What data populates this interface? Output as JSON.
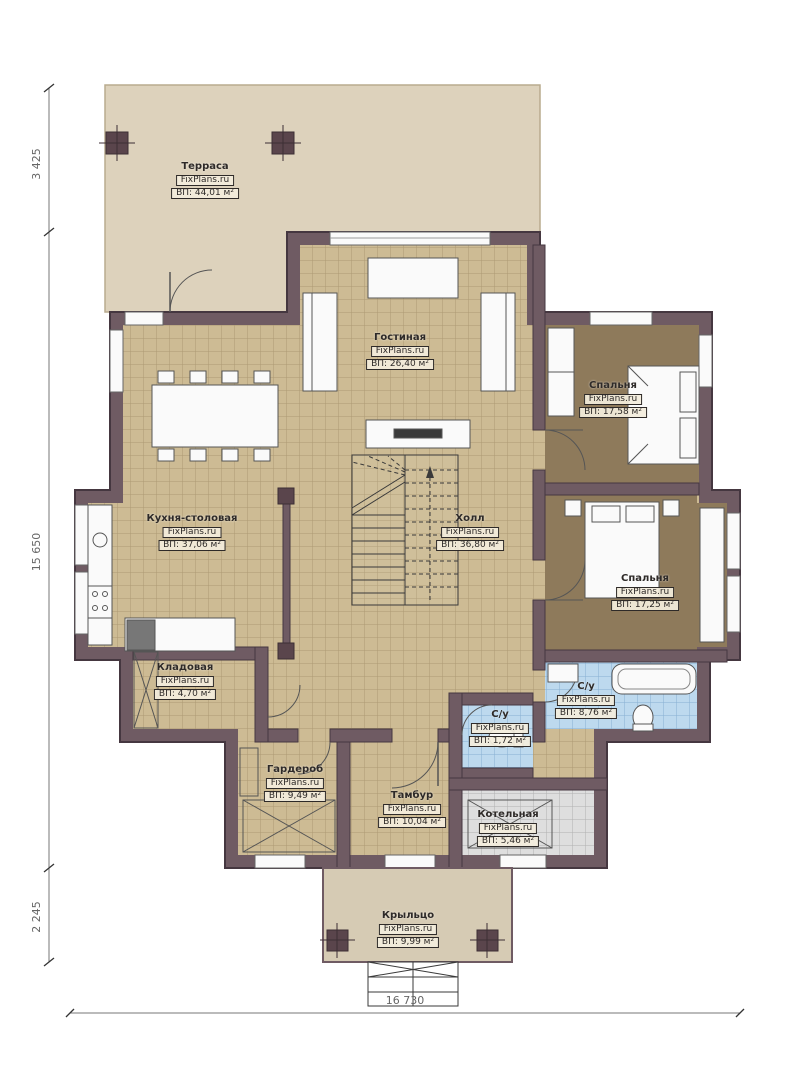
{
  "plan": {
    "brand": "FixPlans.ru",
    "rooms": [
      {
        "id": "terrace",
        "name": "Терраса",
        "area": "ВП: 44,01 м²"
      },
      {
        "id": "living",
        "name": "Гостиная",
        "area": "ВП: 26,40 м²"
      },
      {
        "id": "bedroom1",
        "name": "Спальня",
        "area": "ВП: 17,58 м²"
      },
      {
        "id": "kitchen",
        "name": "Кухня-столовая",
        "area": "ВП: 37,06 м²"
      },
      {
        "id": "hall",
        "name": "Холл",
        "area": "ВП: 36,80 м²"
      },
      {
        "id": "bedroom2",
        "name": "Спальня",
        "area": "ВП: 17,25 м²"
      },
      {
        "id": "pantry",
        "name": "Кладовая",
        "area": "ВП: 4,70 м²"
      },
      {
        "id": "bath1",
        "name": "С/у",
        "area": "ВП: 8,76 м²"
      },
      {
        "id": "bath2",
        "name": "С/у",
        "area": "ВП: 1,72 м²"
      },
      {
        "id": "wardrobe",
        "name": "Гардероб",
        "area": "ВП: 9,49 м²"
      },
      {
        "id": "vestibule",
        "name": "Тамбур",
        "area": "ВП: 10,04 м²"
      },
      {
        "id": "boiler",
        "name": "Котельная",
        "area": "ВП: 5,46 м²"
      },
      {
        "id": "porch",
        "name": "Крыльцо",
        "area": "ВП: 9,99 м²"
      }
    ],
    "dimensions": {
      "left_top": "3 425",
      "left_middle": "15 650",
      "left_bottom": "2 245",
      "bottom": "16 730"
    },
    "colors": {
      "wall": "#6f5b63",
      "wall_outline": "#453740",
      "floor_tile": "#cdbb94",
      "floor_bedroom": "#8e7a5b",
      "floor_bath": "#bdd9ee",
      "floor_boiler": "#dedede",
      "terrace": "#ddd2bc",
      "porch": "#d6cbb4",
      "column": "#5a454c"
    }
  }
}
